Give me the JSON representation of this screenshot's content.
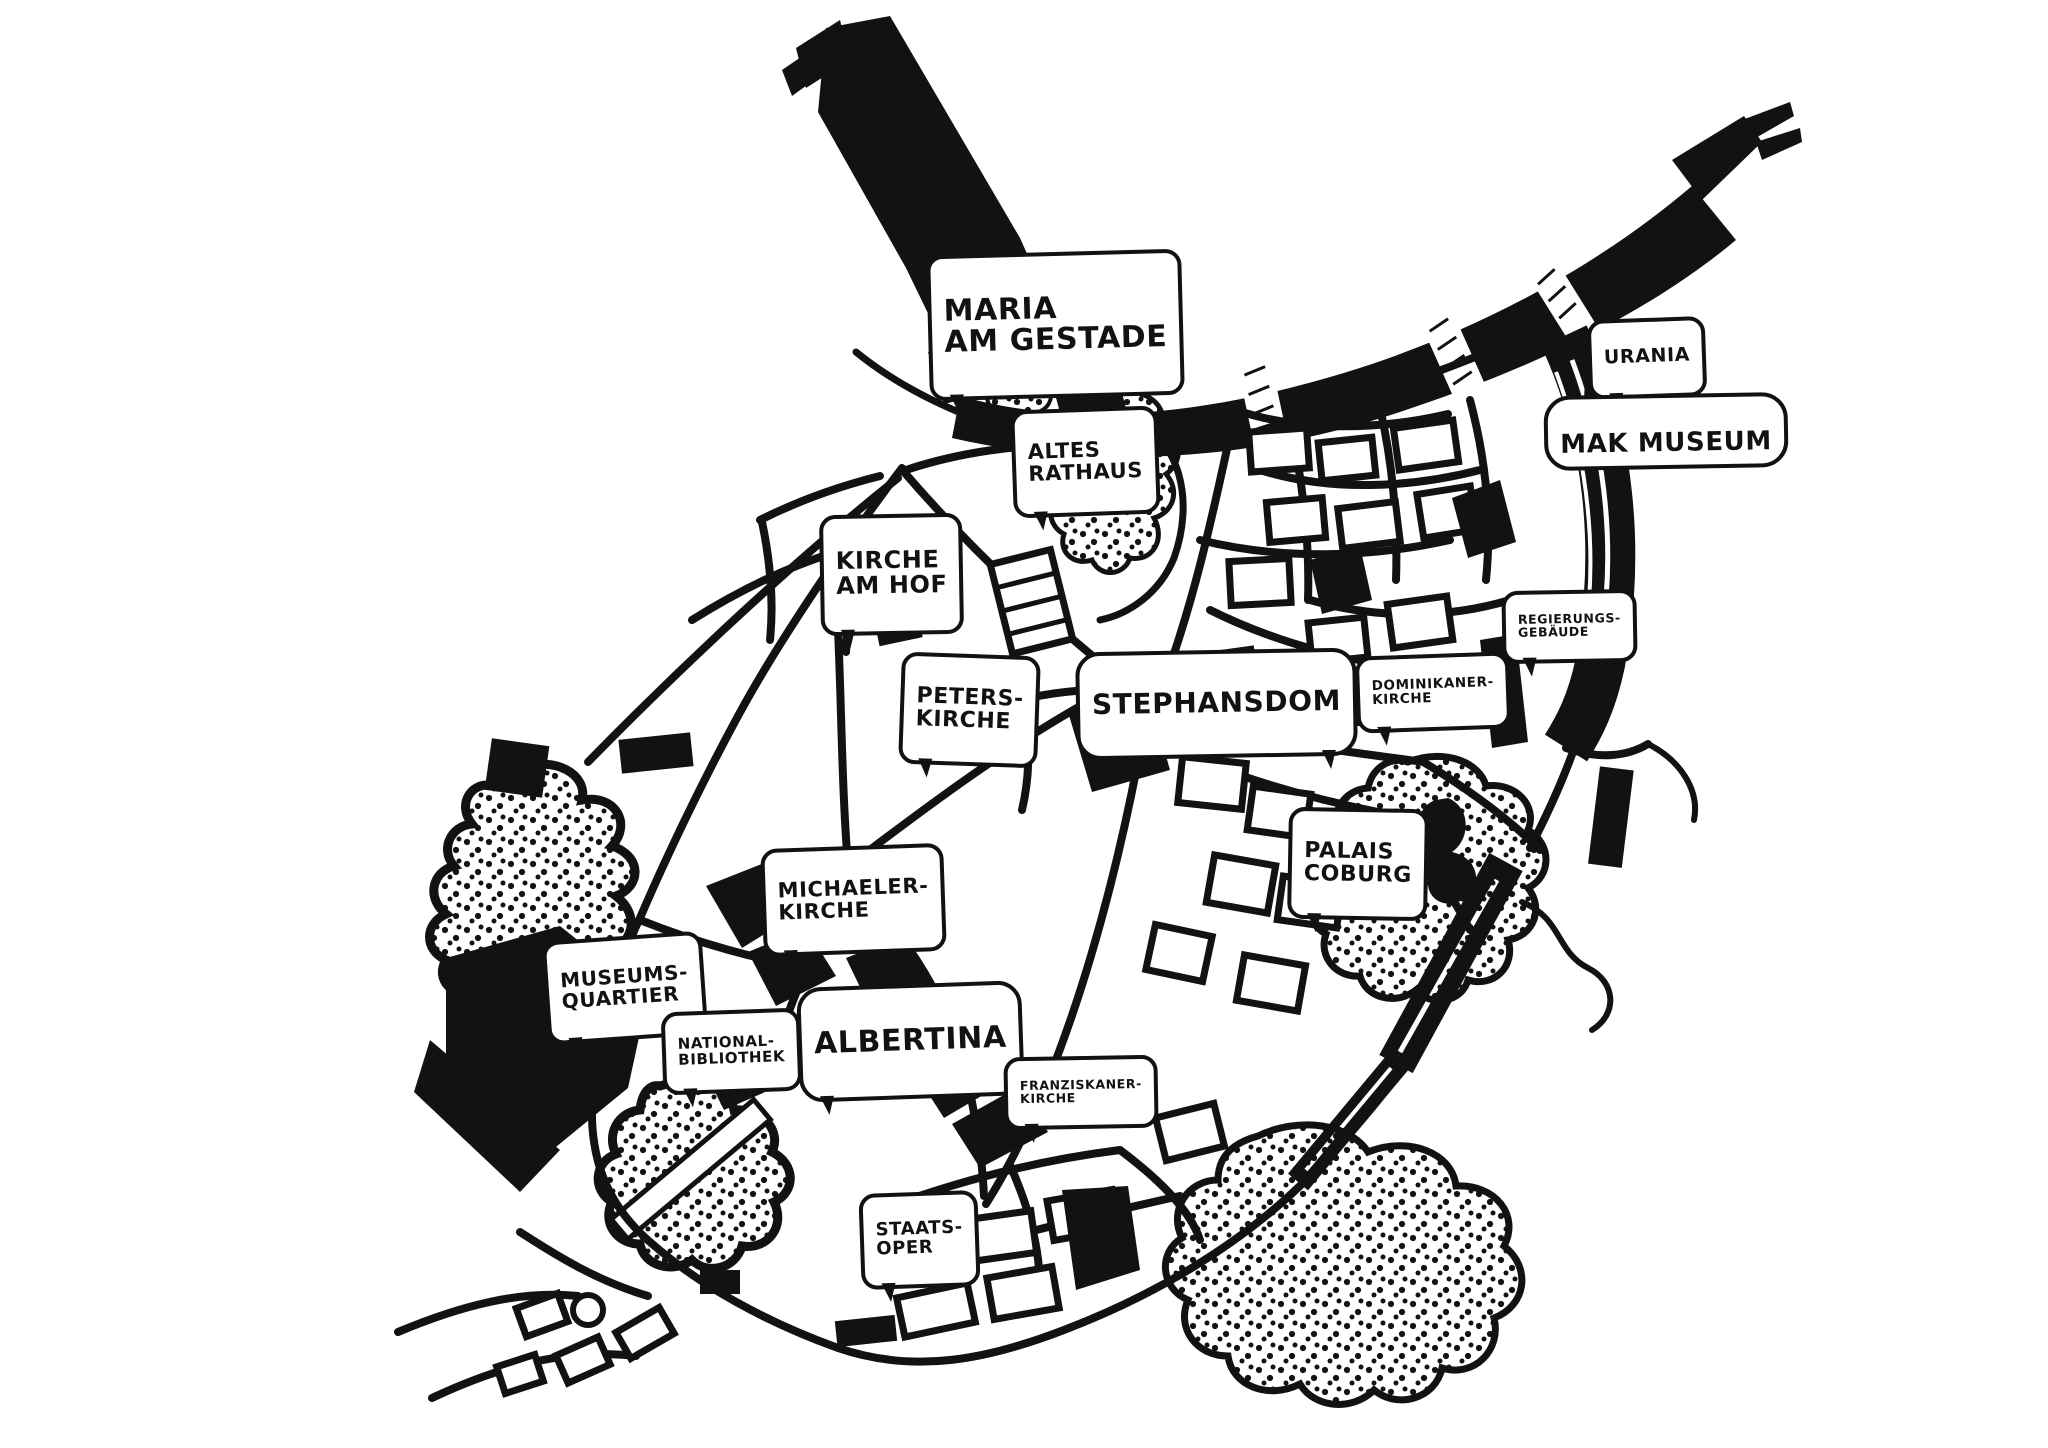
{
  "meta": {
    "title": "Hand-drawn ink map of Vienna city centre (Innere Stadt)",
    "style": "black ink illustration on white paper",
    "colors": {
      "ink": "#121212",
      "paper": "#ffffff"
    }
  },
  "map": {
    "landmarks": [
      {
        "id": "maria-am-gestade",
        "text": "Maria\nam Gestade"
      },
      {
        "id": "altes-rathaus",
        "text": "Altes\nRathaus"
      },
      {
        "id": "urania",
        "text": "Urania"
      },
      {
        "id": "mak-museum",
        "text": "MAK Museum"
      },
      {
        "id": "kirche-am-hof",
        "text": "Kirche\nam Hof"
      },
      {
        "id": "regierungsgebaeude",
        "text": "Regierungs-\ngebäude"
      },
      {
        "id": "peterskirche",
        "text": "Peters-\nkirche"
      },
      {
        "id": "stephansdom",
        "text": "Stephansdom"
      },
      {
        "id": "dominikanerkirche",
        "text": "Dominikaner-\nkirche"
      },
      {
        "id": "palais-coburg",
        "text": "Palais\nCoburg"
      },
      {
        "id": "michaelerkirche",
        "text": "Michaeler-\nkirche"
      },
      {
        "id": "museumsquartier",
        "text": "Museums-\nquartier"
      },
      {
        "id": "nationalbibliothek",
        "text": "National-\nbibliothek"
      },
      {
        "id": "albertina",
        "text": "Albertina"
      },
      {
        "id": "franziskanerkirche",
        "text": "Franziskaner-\nkirche"
      },
      {
        "id": "staatsoper",
        "text": "Staats-\noper"
      }
    ],
    "features": [
      "danube-canal-brush-stroke",
      "ring-road-band",
      "street-network",
      "city-blocks",
      "stippled-parks",
      "stadtpark-lake",
      "wien-river",
      "bridge-gaps",
      "fountain-circle"
    ]
  }
}
